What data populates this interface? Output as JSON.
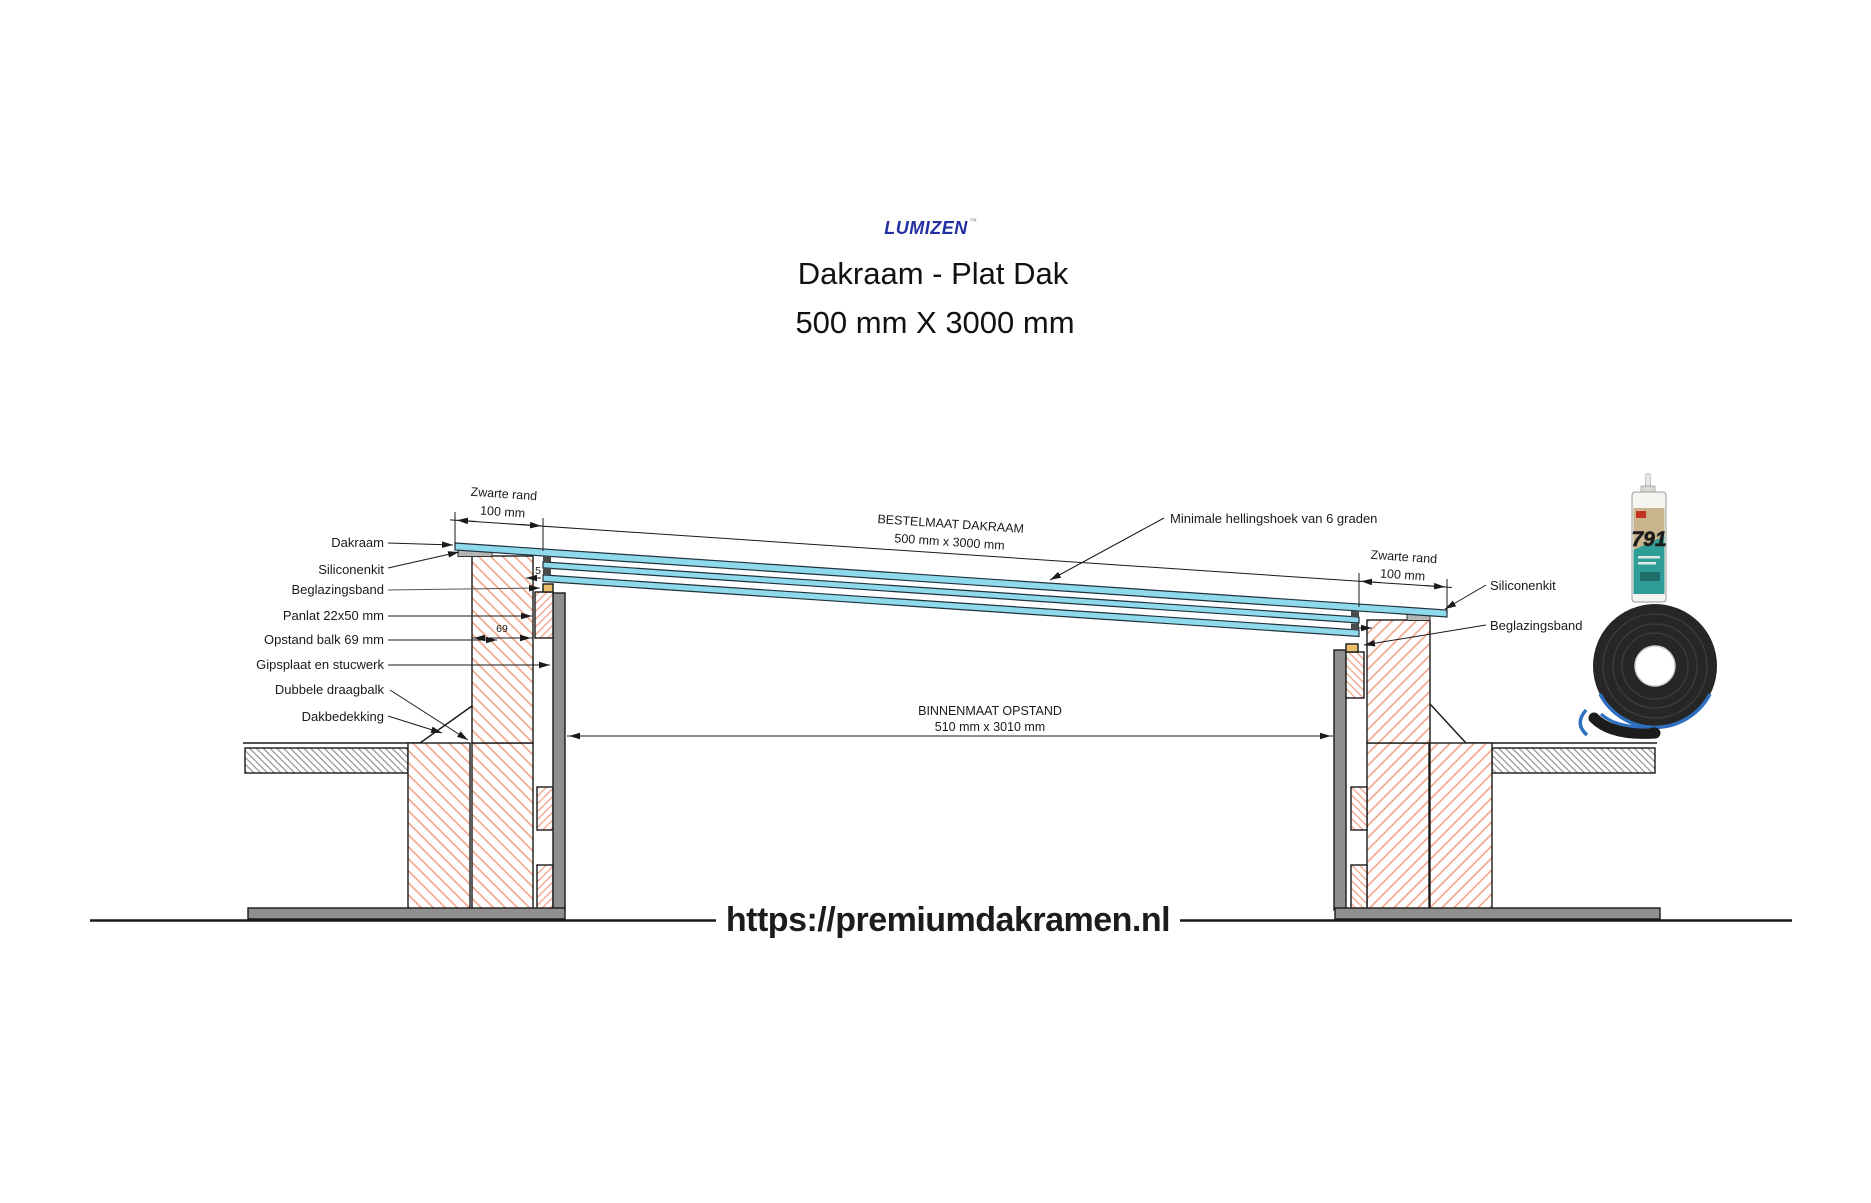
{
  "header": {
    "logo": "LUMIZEN",
    "logo_tm": "™",
    "title_line1": "Dakraam - Plat Dak",
    "title_line2": "500 mm X 3000 mm"
  },
  "footer": {
    "url": "https://premiumdakramen.nl"
  },
  "diagram": {
    "labels_left": [
      "Dakraam",
      "Siliconenkit",
      "Beglazingsband",
      "Panlat 22x50 mm",
      "Opstand balk 69 mm",
      "Gipsplaat en stucwerk",
      "Dubbele draagbalk",
      "Dakbedekking"
    ],
    "labels_right": {
      "siliconenkit": "Siliconenkit",
      "beglazingsband": "Beglazingsband",
      "hellingshoek": "Minimale hellingshoek van 6 graden"
    },
    "dimensions": {
      "bestelmaat_title": "BESTELMAAT DAKRAAM",
      "bestelmaat_value": "500 mm x 3000 mm",
      "binnenmaat_title": "BINNENMAAT OPSTAND",
      "binnenmaat_value": "510 mm x 3010 mm",
      "zwarte_rand": "Zwarte rand",
      "zwarte_rand_value": "100 mm",
      "opstand_width": "69",
      "glass_edge_step": "5"
    },
    "colors": {
      "glass_blue": "#8ed9ec",
      "wood_hatch": "#f2a287",
      "deck_hatch": "#7d7d7d",
      "panel_gray": "#8f8f8f",
      "silicone_gray": "#b5b5b5",
      "glazing_band_tan": "#e9bf6f",
      "line_black": "#1a1a1a",
      "logo_blue": "#2330a2"
    }
  },
  "products": {
    "silicone_label": "791"
  }
}
